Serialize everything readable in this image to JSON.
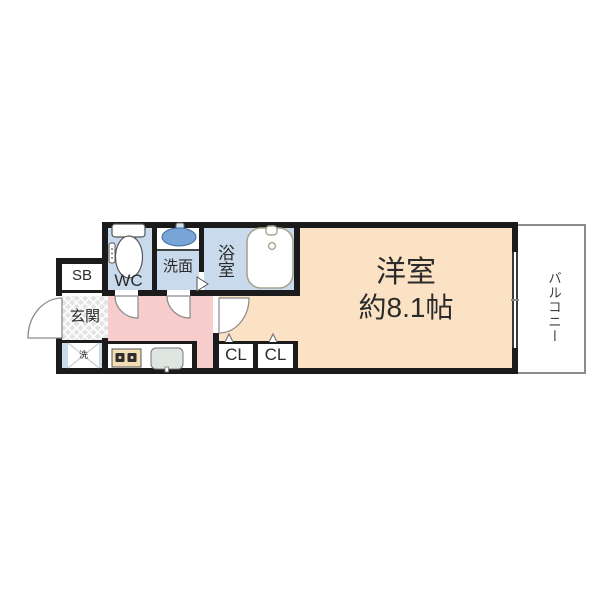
{
  "floor_plan": {
    "rooms": {
      "main_room": {
        "label": "洋室",
        "size": "約8.1帖"
      },
      "balcony": {
        "label": "バルコニー"
      },
      "bath": {
        "label": "浴室"
      },
      "washroom": {
        "label": "洗面"
      },
      "toilet": {
        "label": "WC"
      },
      "shoe_box": {
        "label": "SB"
      },
      "entrance": {
        "label": "玄関"
      },
      "laundry": {
        "label": "洗"
      },
      "closet_1": {
        "label": "CL"
      },
      "closet_2": {
        "label": "CL"
      }
    },
    "colors": {
      "wall": "#1b1b1b",
      "main_room_fill": "#fbe2c4",
      "corridor_fill": "#f6cdcc",
      "wet_area_fill": "#c8daec",
      "entrance_fill": "#e3e3e3",
      "balcony_border": "#8c8c8c",
      "basin_blue": "#78a5d8",
      "stove_fill": "#f4deb4",
      "kitchen_sink_fill": "#dde6e0",
      "text": "#2b2b2b"
    }
  }
}
